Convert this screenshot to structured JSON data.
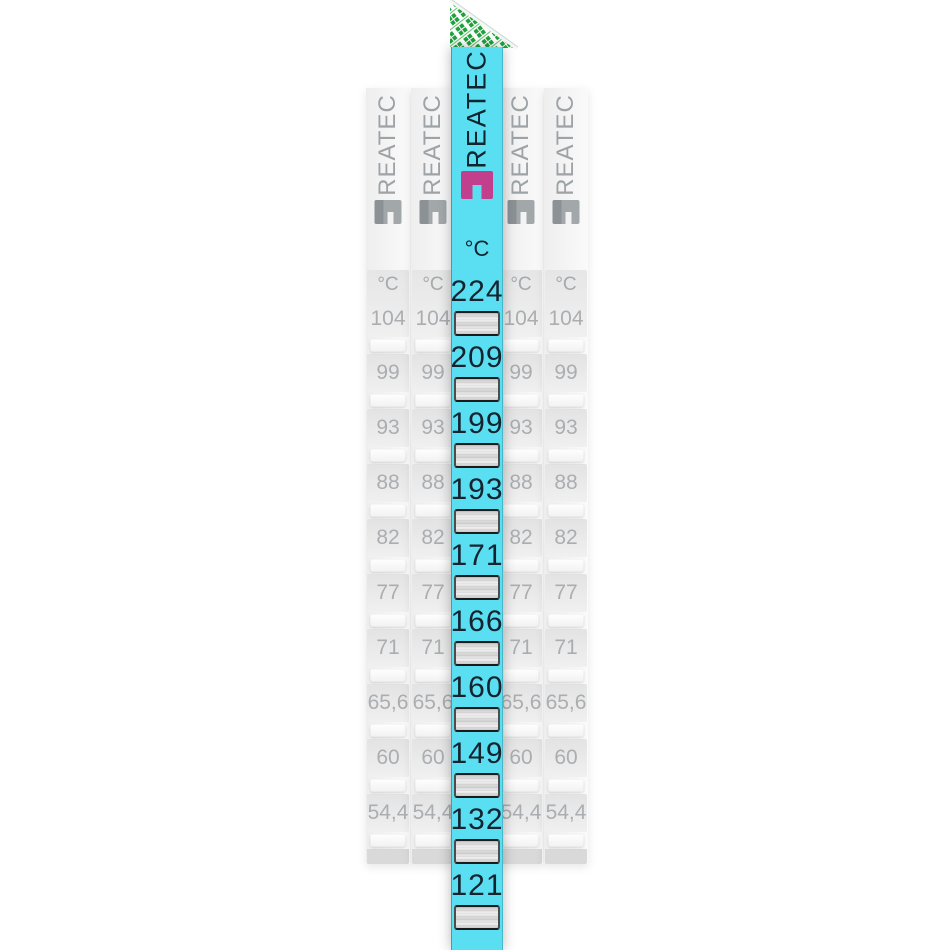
{
  "product": {
    "brand": "REATEC",
    "unit": "°C"
  },
  "featured_strip": {
    "brand": "REATEC",
    "unit": "°C",
    "values": [
      "224",
      "209",
      "199",
      "193",
      "171",
      "166",
      "160",
      "149",
      "132",
      "121"
    ]
  },
  "background_strips": {
    "brand": "REATEC",
    "unit": "°C",
    "count": 4,
    "values": [
      "104",
      "99",
      "93",
      "88",
      "82",
      "77",
      "71",
      "65,6",
      "60",
      "54,4"
    ]
  },
  "colors": {
    "strip_cyan": "#59dff1",
    "logo_magenta": "#c23f8e",
    "liner_green": "#1fa23c",
    "value_dark": "#14232f",
    "value_gray": "#abaeb1",
    "window_metal": "#d3d3d3"
  }
}
